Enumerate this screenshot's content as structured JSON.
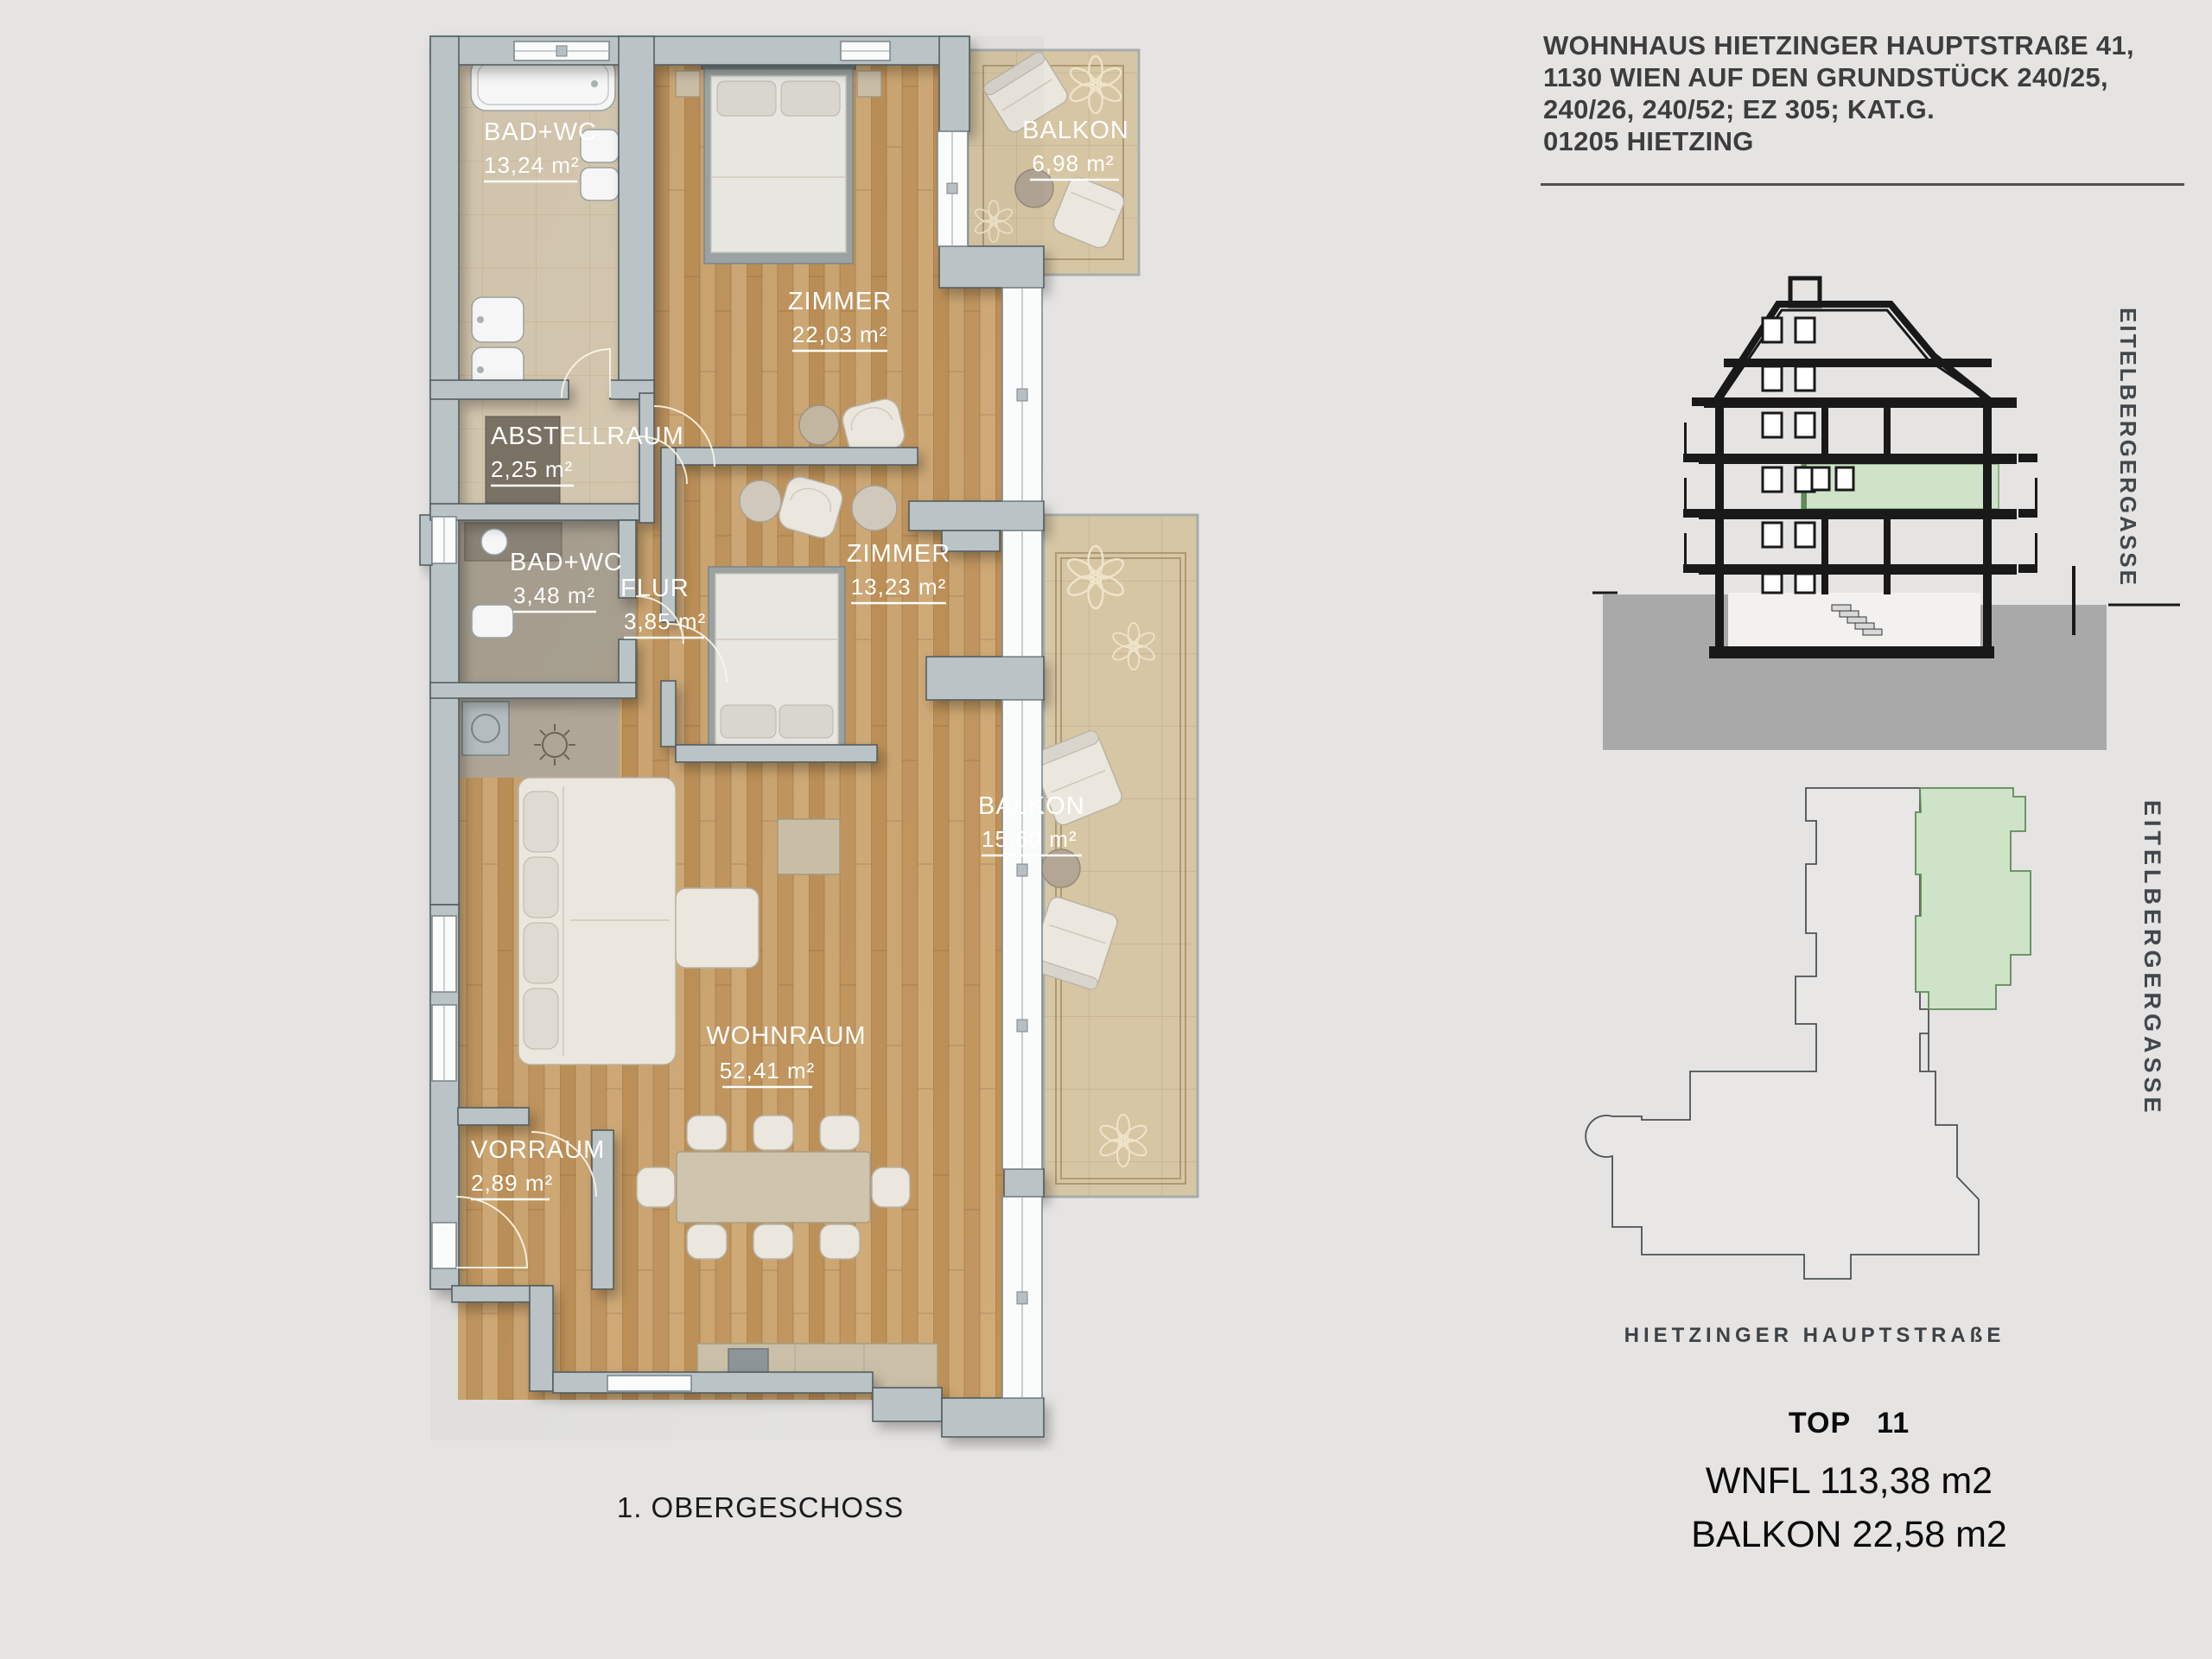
{
  "page": {
    "background": "#e5e4e2",
    "highlight_green": "#cfe3c8"
  },
  "header": {
    "lines": [
      "WOHNHAUS HIETZINGER HAUPTSTRAßE 41,",
      "1130 WIEN AUF DEN GRUNDSTÜCK 240/25,",
      "240/26, 240/52; EZ 305; KAT.G.",
      "01205 HIETZING"
    ]
  },
  "floor_plan": {
    "caption": "1. OBERGESCHOSS",
    "rooms": [
      {
        "id": "bad_wc_1",
        "name": "BAD+WC",
        "area": "13,24 m²"
      },
      {
        "id": "zimmer_1",
        "name": "ZIMMER",
        "area": "22,03 m²"
      },
      {
        "id": "balkon_1",
        "name": "BALKON",
        "area": "6,98 m²"
      },
      {
        "id": "abstellraum",
        "name": "ABSTELLRAUM",
        "area": "2,25 m²"
      },
      {
        "id": "bad_wc_2",
        "name": "BAD+WC",
        "area": "3,48 m²"
      },
      {
        "id": "flur",
        "name": "FLUR",
        "area": "3,85 m²"
      },
      {
        "id": "zimmer_2",
        "name": "ZIMMER",
        "area": "13,23 m²"
      },
      {
        "id": "balkon_2",
        "name": "BALKON",
        "area": "15,60 m²"
      },
      {
        "id": "wohnraum",
        "name": "WOHNRAUM",
        "area": "52,41 m²"
      },
      {
        "id": "vorraum",
        "name": "VORRAUM",
        "area": "2,89 m²"
      }
    ]
  },
  "section": {
    "street_label": "EITELBERGERGASSE"
  },
  "site_plan": {
    "street_side": "EITELBERGERGASSE",
    "street_bottom": "HIETZINGER HAUPTSTRAßE"
  },
  "summary": {
    "unit_label": "TOP",
    "unit_number": "11",
    "wnfl": "WNFL 113,38 m2",
    "balkon": "BALKON 22,58 m2"
  }
}
